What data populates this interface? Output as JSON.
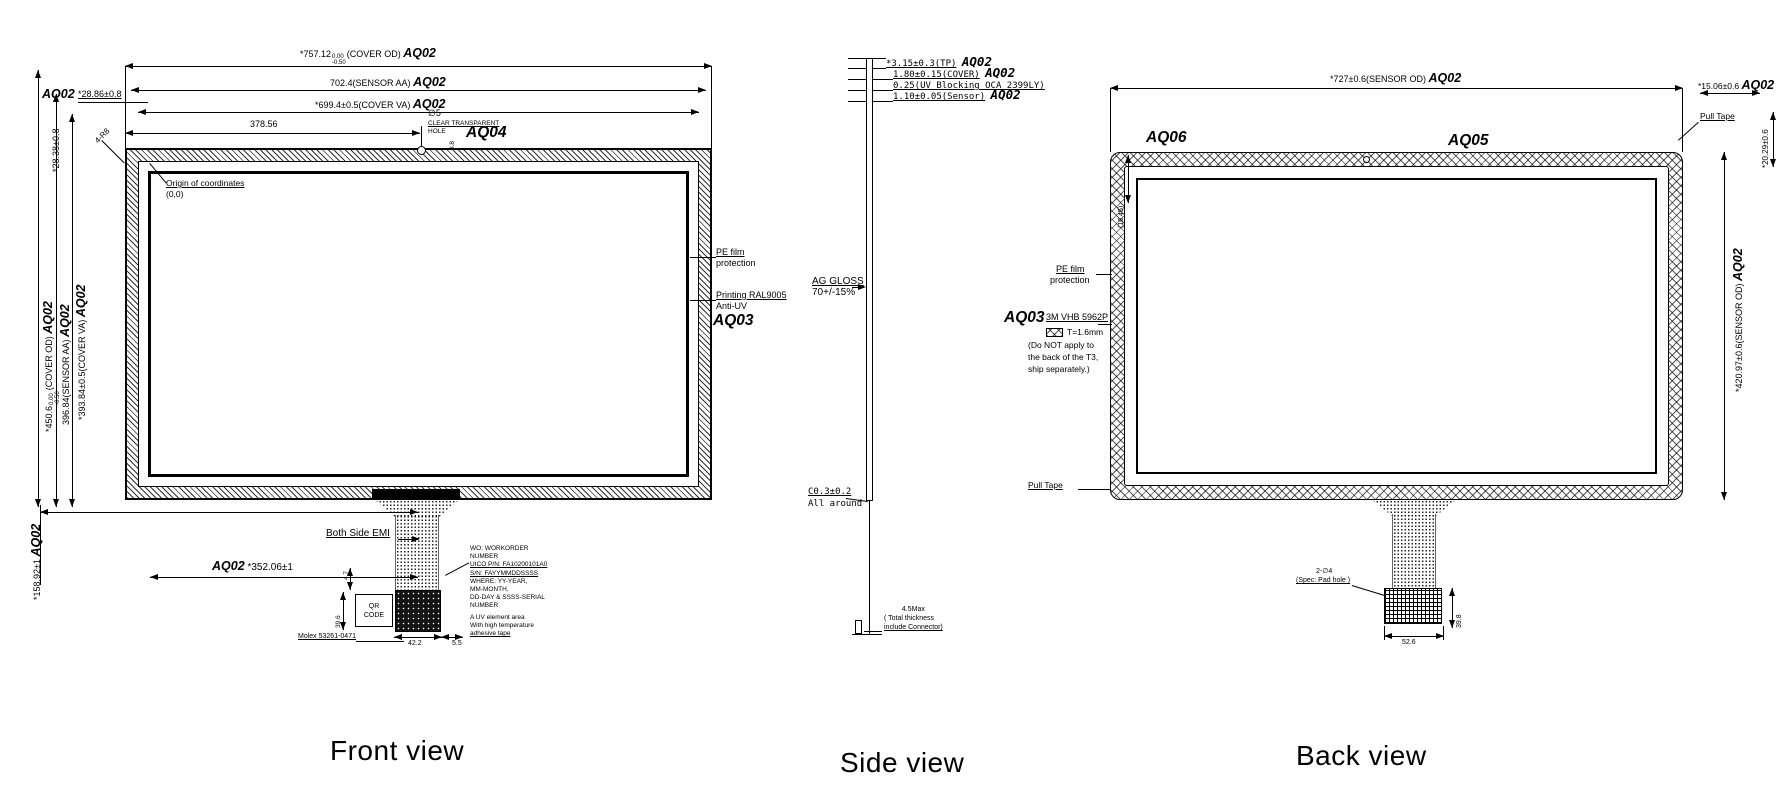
{
  "colors": {
    "line": "#000000",
    "background": "#ffffff"
  },
  "titles": {
    "front": "Front view",
    "side": "Side view",
    "back": "Back view"
  },
  "front": {
    "dim_cover_od": {
      "val": "*757.12",
      "tol_up": "0.00",
      "tol_dn": "-0.50",
      "suffix": "(COVER OD)",
      "tag": "AQ02"
    },
    "dim_sensor_aa": {
      "val": "702.4(SENSOR AA)",
      "tag": "AQ02"
    },
    "dim_cover_va": {
      "val": "*699.4±0.5(COVER VA)",
      "tag": "AQ02"
    },
    "dim_hole_x": "378.56",
    "hole": {
      "dia": "∅5",
      "note1": "CLEAR TRANSPARENT",
      "note2": "HOLE",
      "height": "8.8",
      "tag": "AQ04"
    },
    "corner": {
      "tag": "AQ02",
      "dim_h": "*28.86±0.8",
      "dim_v": "*28.38±0.8",
      "radius": "4-R8"
    },
    "origin": {
      "line1": "Origin of coordinates",
      "line2": "(0,0)"
    },
    "dim_v_cover_od": {
      "val": "*450.6",
      "tol_up": "0.00",
      "tol_dn": "-0.50",
      "suffix": "(COVER OD)",
      "tag": "AQ02"
    },
    "dim_v_sensor_aa": {
      "val": "396.84(SENSOR AA)",
      "tag": "AQ02"
    },
    "dim_v_cover_va": {
      "val": "*393.84±0.5(COVER VA)",
      "tag": "AQ02"
    },
    "dim_v_tail": {
      "val": "*158.92±1",
      "tag": "AQ02"
    },
    "dim_tail_x": {
      "tag": "AQ02",
      "val": "*352.06±1"
    },
    "emi_label": "Both Side EMI",
    "pe_film": {
      "line1": "PE film",
      "line2": "protection"
    },
    "printing": {
      "line1": "Printing RAL9005",
      "line2": "Anti-UV",
      "tag": "AQ03"
    },
    "wo_block": [
      "WO: WORKORDER",
      "NUMBER",
      "UICO P/N: FA10200101A0",
      "S/N: FAYYMMDDSSSS",
      "WHERE: YY-YEAR,",
      "MM-MONTH,",
      "DD-DAY & SSSS-SERIAL",
      "NUMBER"
    ],
    "uv_block": [
      "A UV element area",
      "With high temperature",
      "adhesive tape"
    ],
    "qr": {
      "line1": "QR",
      "line2": "CODE"
    },
    "connector": "Molex 53261-0471",
    "dim_47": "4.7",
    "dim_396": "39.6",
    "dim_422": "42.2",
    "dim_55": "5.5"
  },
  "side": {
    "stack": [
      {
        "val": "*3.15±0.3(TP)",
        "tag": "AQ02"
      },
      {
        "val": "1.80±0.15(COVER)",
        "tag": "AQ02"
      },
      {
        "val": "0.25(UV Blocking OCA 2399LY)",
        "tag": ""
      },
      {
        "val": "1.10±0.05(Sensor)",
        "tag": "AQ02"
      }
    ],
    "gloss": {
      "line1": "AG GLOSS",
      "line2": "70+/-15%"
    },
    "chamfer": {
      "line1": "C0.3±0.2",
      "line2": "All around"
    },
    "thickness": {
      "line1": "4.5Max",
      "line2": "( Total thickness",
      "line3": "include Connector)"
    }
  },
  "back": {
    "dim_sensor_od_h": {
      "val": "*727±0.6(SENSOR OD)",
      "tag": "AQ02"
    },
    "dim_1506": {
      "val": "*15.06±0.6",
      "tag": "AQ02"
    },
    "dim_1645": "(16.45)",
    "tag_aq06": "AQ06",
    "tag_aq05": "AQ05",
    "pull_tape_top": "Pull Tape",
    "pull_tape_bottom": "Pull Tape",
    "dim_2029": "*20.29±0.6",
    "dim_sensor_od_v": {
      "val": "*420.97±0.6(SENSOR OD)",
      "tag": "AQ02"
    },
    "pe_film": {
      "line1": "PE film",
      "line2": "protection"
    },
    "vhb": {
      "tag": "AQ03",
      "name": "3M VHB 5962P",
      "thick": "T=1.6mm",
      "note1": "(Do NOT apply to",
      "note2": "the back of the T3,",
      "note3": "ship separately.)"
    },
    "pad": {
      "line1": "2-∅4",
      "line2": "(Spec: Pad hole )"
    },
    "dim_526": "52.6",
    "dim_398": "39.8"
  }
}
